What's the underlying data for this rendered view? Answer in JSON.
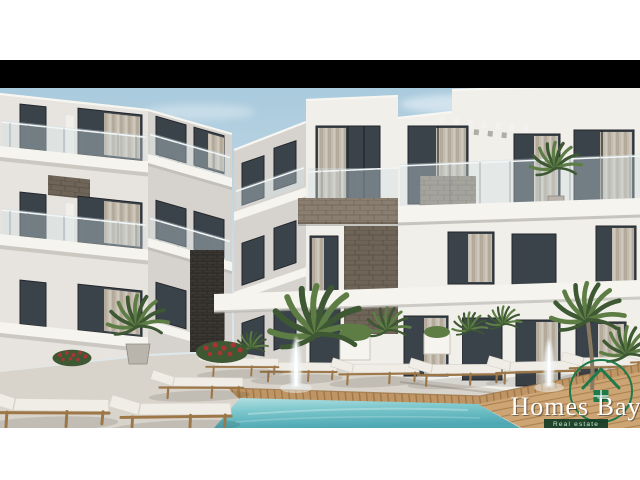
{
  "frame": {
    "background": "#ffffff",
    "letterbox_color": "#000000",
    "description": "architectural render of three-story white apartment complex with stone accents around a pool"
  },
  "logo": {
    "brand": "Homes Bay",
    "tagline": "Real estate",
    "icon": "house-in-circle-icon",
    "accent_color": "#1e7a4a",
    "text_color": "#ffffff"
  },
  "colors": {
    "sky_top": "#a9cadd",
    "sky_bottom": "#e9efee",
    "cloud": "#ffffff",
    "wall_bright": "#f1efea",
    "wall_light": "#e7e4df",
    "wall_mid": "#d6d3ce",
    "wall_dark": "#c3bfb9",
    "glass": "#3a424a",
    "glass_light": "#8fa3ad",
    "curtain": "#cfc5b6",
    "curtain_dark": "#b9ad9c",
    "stone": "#8a7e70",
    "stone_dark": "#6e6458",
    "stone_black": "#3a3733",
    "slab": "#f6f4ef",
    "slab_shadow": "#b4b0aa",
    "rail_glass": "#cfdfe6",
    "terrace": "#d9d4cb",
    "terrace_dark": "#c9c3ba",
    "wood": "#bf9565",
    "wood_dark": "#9d7748",
    "wood_light": "#cda473",
    "pool_light": "#b3e0e2",
    "pool": "#7ac6cb",
    "pool_deep": "#4fa9b4",
    "plant_dark": "#3d5833",
    "plant_mid": "#5d7d45",
    "plant_light": "#7da05c",
    "flower_red": "#a83434",
    "pot": "#b9b4ac",
    "pot_dark": "#8e8981",
    "cushion": "#f0ede7",
    "cushion_shade": "#d8d4cc",
    "fountain": "#eef4f4",
    "logo_green": "#1e7a4a",
    "logo_band": "#123d26",
    "logo_text": "#ffffff",
    "logo_tag_text": "#cfe8d8"
  }
}
